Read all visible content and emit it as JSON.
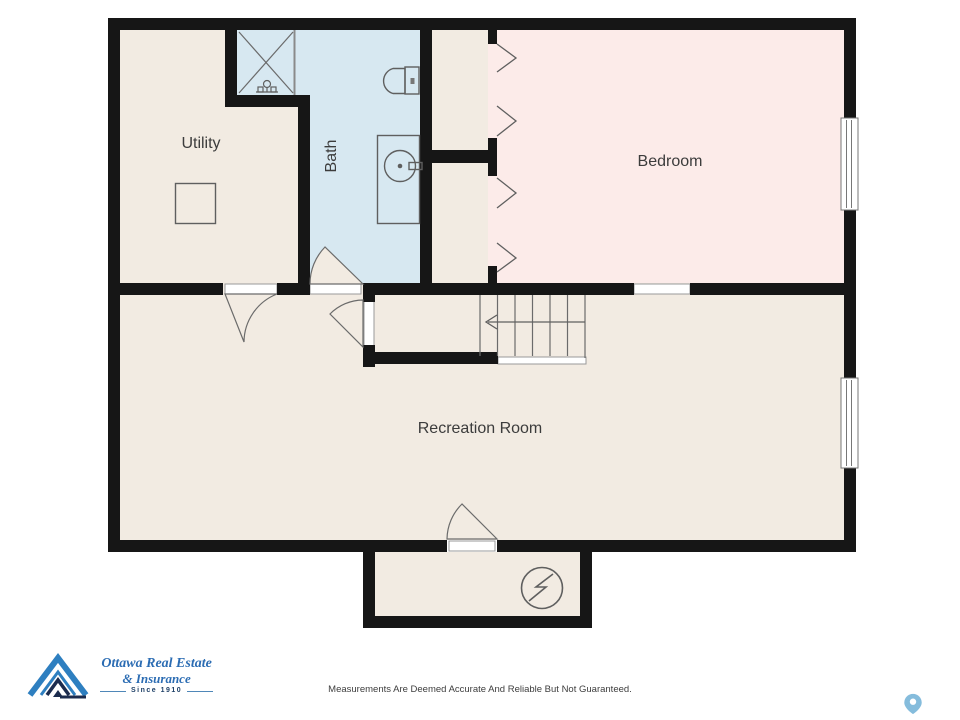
{
  "colors": {
    "floor_beige": "#f2ebe2",
    "bath_blue": "#d7e8f1",
    "bedroom_pink": "#fcebe9",
    "wall_black": "#161616",
    "logo_blue": "#2e7fc0",
    "logo_navy": "#1c2c4e",
    "script_blue": "#2b6cb3",
    "pin_blue": "#85bcdc"
  },
  "rooms": {
    "utility": "Utility",
    "bath": "Bath",
    "bedroom": "Bedroom",
    "recreation": "Recreation Room"
  },
  "footer": {
    "brand_name_line1": "Ottawa Real Estate",
    "brand_name_line2": "& Insurance",
    "brand_tagline": "Since 1910",
    "disclaimer": "Measurements Are Deemed Accurate And Reliable But Not Guaranteed."
  }
}
